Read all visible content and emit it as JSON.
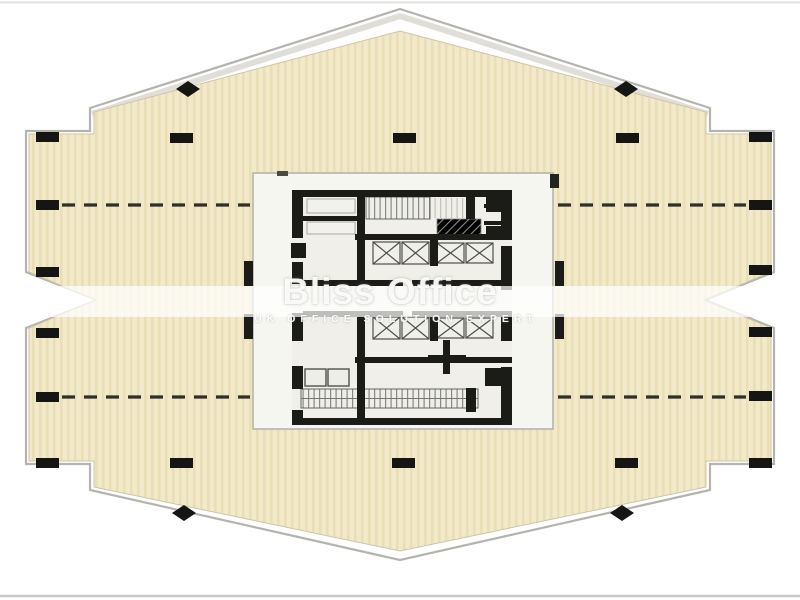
{
  "watermark": {
    "title": "Bliss Office",
    "tagline": "UK OFFICE SOLUTION EXPERT"
  },
  "colors": {
    "background": "#ffffff",
    "floor-fill": "#f2e9ca",
    "floor-stripe": "#eadfb4",
    "outline": "#b5b3ad",
    "outline-soft": "#d8d6ce",
    "wall": "#1b1b18",
    "core-zone": "#f6f6f1",
    "core-floor": "#f0efe9",
    "column": "#151513",
    "dash": "#2e2e2a",
    "photo-border-top": "#e3e2de",
    "photo-border-bottom": "#c9c8c4",
    "watermark-band": "#ffffff"
  }
}
